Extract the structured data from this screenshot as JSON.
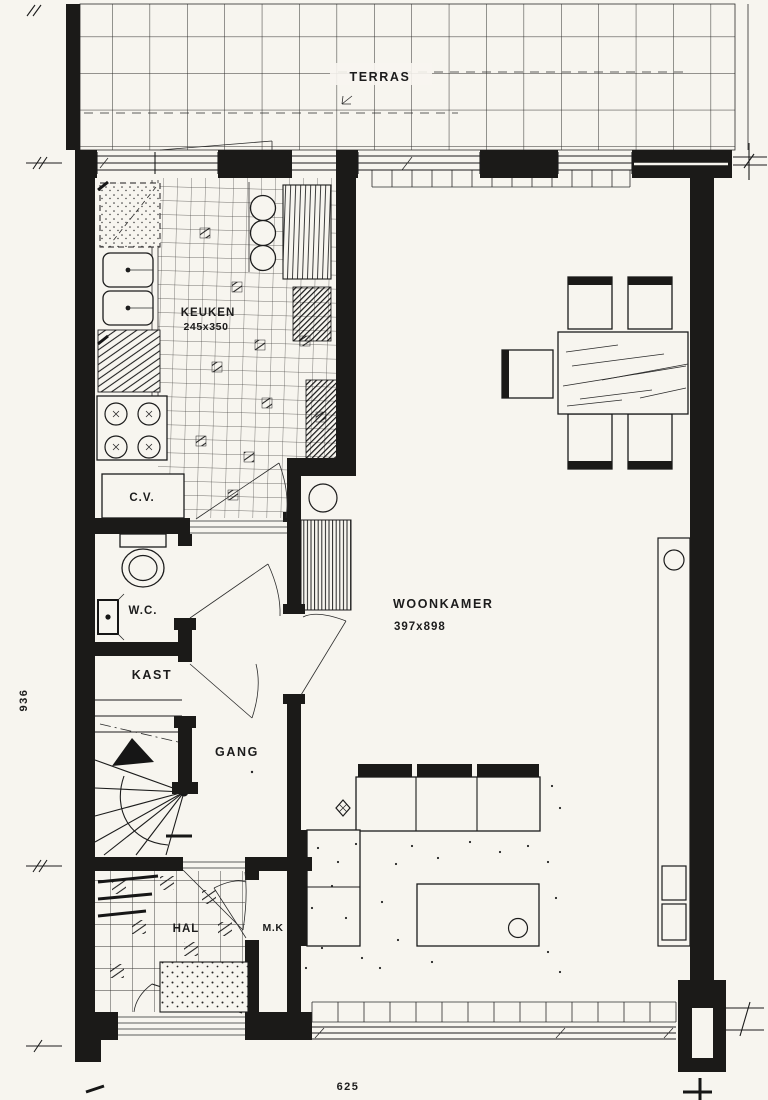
{
  "floorplan": {
    "rooms": {
      "terras": {
        "label": "TERRAS"
      },
      "keuken": {
        "label": "KEUKEN",
        "size": "245x350"
      },
      "woonkamer": {
        "label": "WOONKAMER",
        "size": "397x898"
      },
      "cv": {
        "label": "C.V."
      },
      "wc": {
        "label": "W.C."
      },
      "kast": {
        "label": "KAST"
      },
      "gang": {
        "label": "GANG"
      },
      "hal": {
        "label": "HAL"
      },
      "mk": {
        "label": "M.K"
      }
    },
    "dimensions": {
      "side": "936",
      "bottom": "625"
    },
    "colors": {
      "ink": "#1c1c1c",
      "paper": "#f7f5ef"
    }
  }
}
